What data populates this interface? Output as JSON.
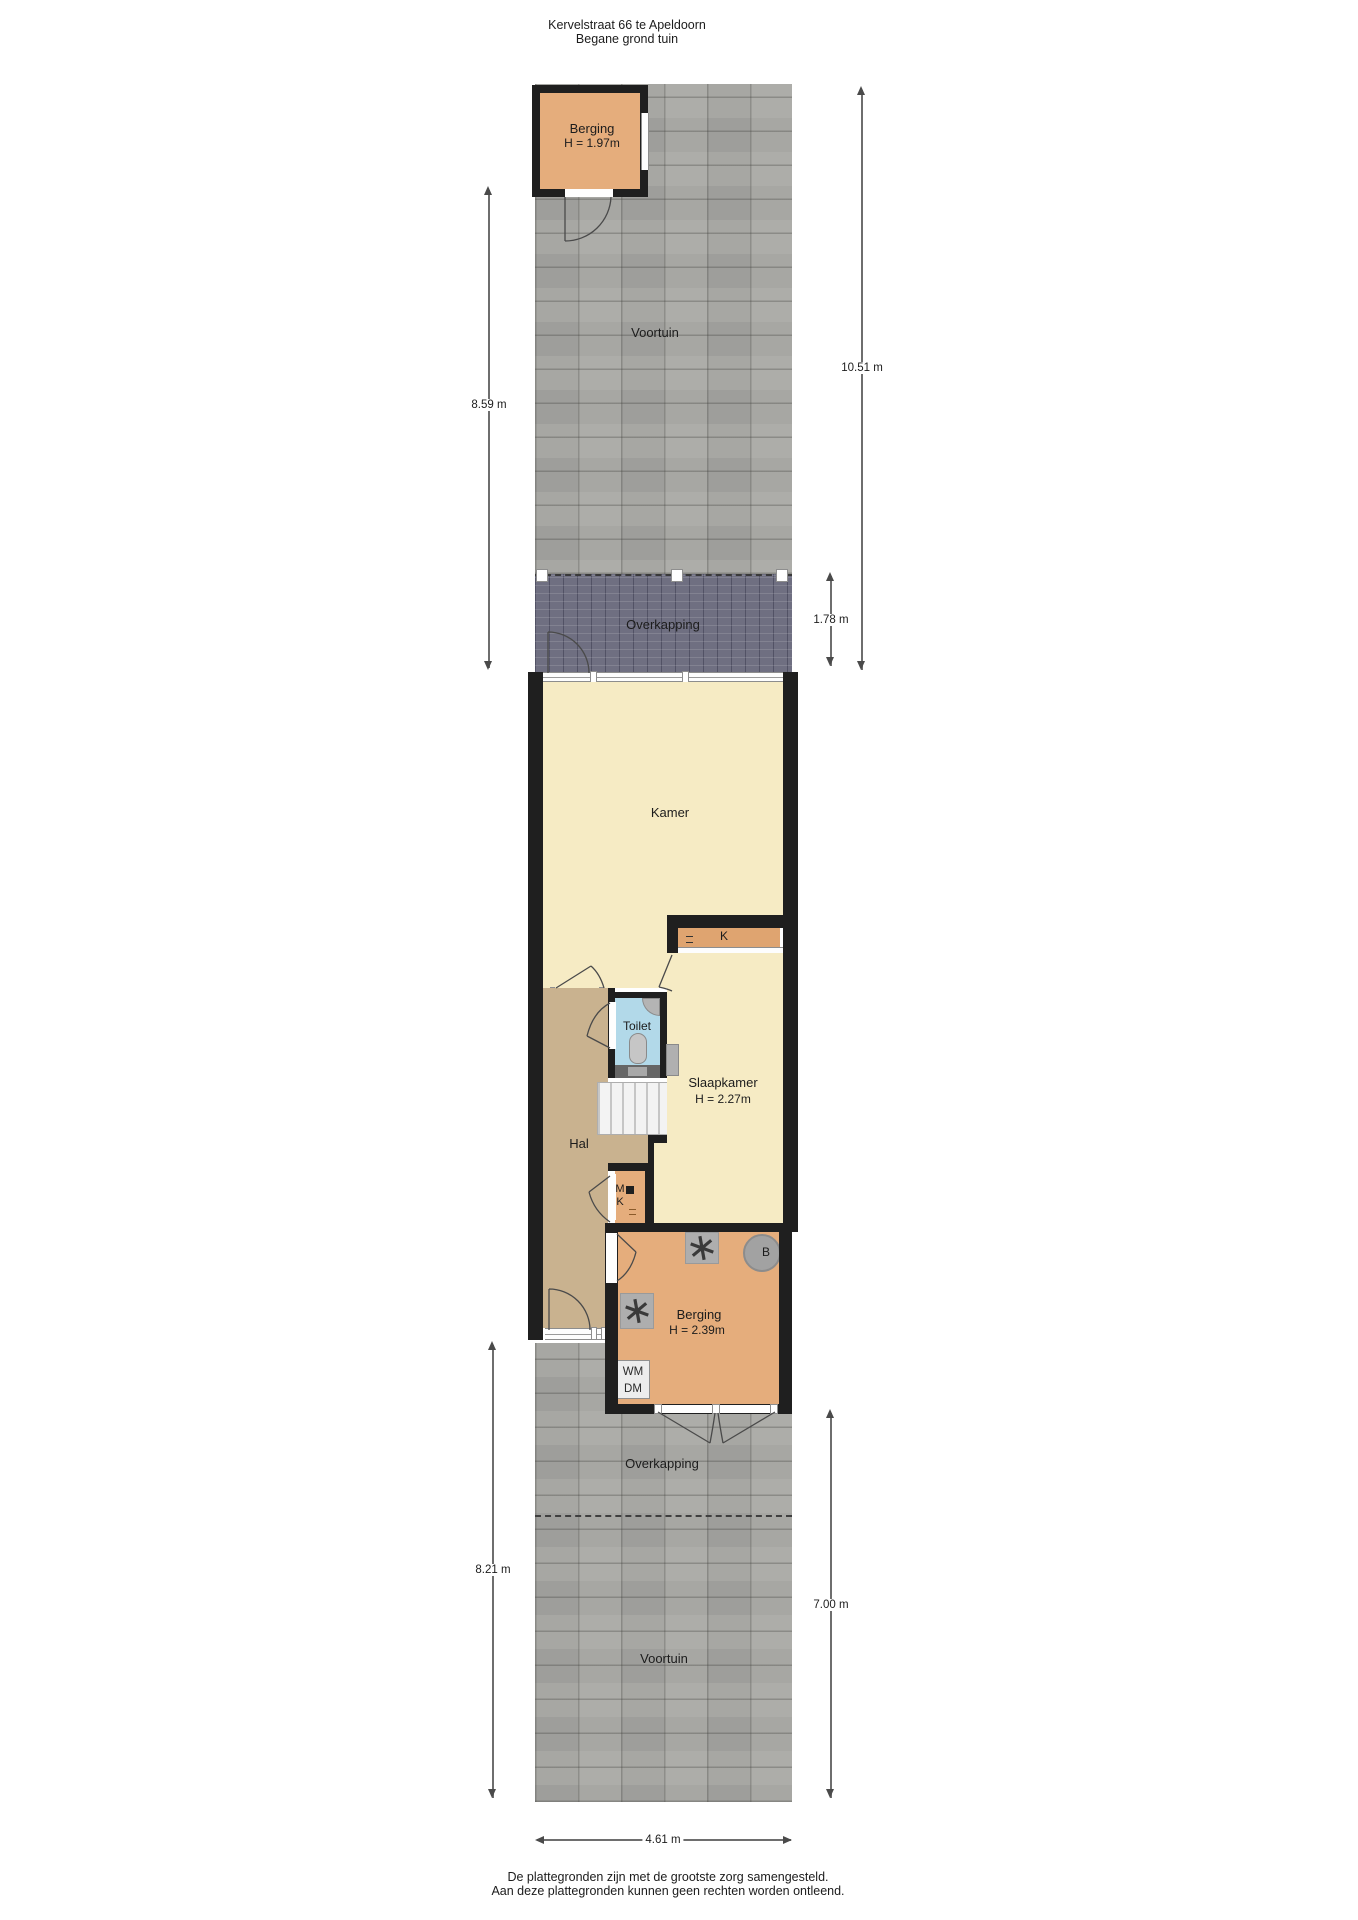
{
  "title": {
    "line1": "Kervelstraat 66 te Apeldoorn",
    "line2": "Begane grond tuin"
  },
  "berging_top": {
    "name": "Berging",
    "height": "H = 1.97m"
  },
  "garden_top": {
    "voortuin": "Voortuin",
    "overkapping": "Overkapping"
  },
  "house": {
    "kamer": "Kamer",
    "kitchen_label": "K",
    "toilet": "Toilet",
    "slaapkamer": "Slaapkamer",
    "slaapkamer_height": "H = 2.27m",
    "hal": "Hal",
    "meterkast_m": "M",
    "meterkast_k": "K"
  },
  "berging_bottom": {
    "name": "Berging",
    "height": "H = 2.39m",
    "boiler": "B",
    "wm": "WM",
    "dm": "DM"
  },
  "garden_bottom": {
    "overkapping": "Overkapping",
    "voortuin": "Voortuin"
  },
  "dimensions": {
    "left_top": "8.59 m",
    "right_top": "10.51 m",
    "overkapping_top": "1.78 m",
    "left_bottom": "8.21 m",
    "right_bottom": "7.00 m",
    "width_bottom": "4.61 m"
  },
  "footer": {
    "line1": "De plattegronden zijn met de grootste zorg samengesteld.",
    "line2": "Aan deze plattegronden kunnen geen rechten worden ontleend."
  },
  "colors": {
    "wall": "#1f1f1f",
    "room-yellow": "#f6ebc4",
    "hal-tan": "#c9b28f",
    "toilet-blue": "#b2d9e9",
    "berging-orange": "#e5ad7c",
    "kitchen-counter": "#dfa470",
    "paving-grey": "#a7a7a3",
    "overkapping-dark": "#6f6f81",
    "dim-line": "#6e6e6e",
    "text": "#1c1c1c"
  }
}
